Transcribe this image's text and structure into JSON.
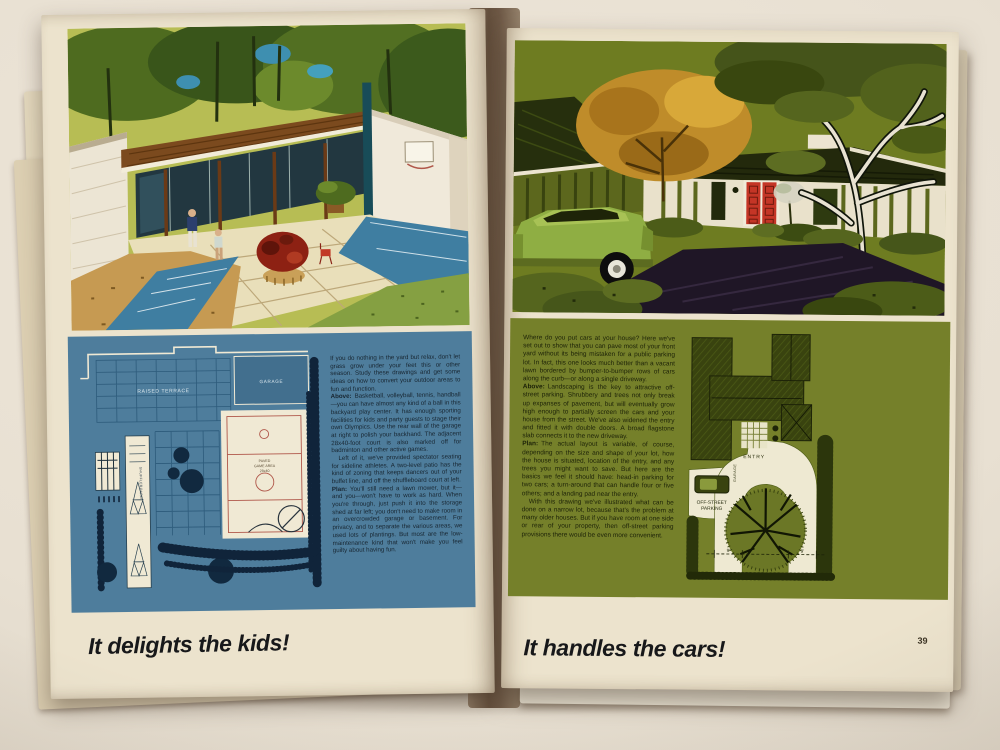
{
  "palette": {
    "page-cream": "#ece3cd",
    "gutter-brown": "#6e5a48",
    "panel-blue": "#4e7d9c",
    "plan-paper": "#f0e9d4",
    "plan-navy": "#14304a",
    "court-red": "#b0574a",
    "panel-olive": "#75802a",
    "roof-olive": "#39430f",
    "caption-black": "#17181a"
  },
  "left_page": {
    "plan": {
      "raised_terrace": "RAISED TERRACE",
      "garage": "GARAGE",
      "game_area_line1": "PAVED",
      "game_area_line2": "GAME AREA",
      "game_area_line3": "28x40",
      "shuffleboard": "SHUFFLEBOARD"
    },
    "text": {
      "paragraphs": [
        {
          "lead": "",
          "body": "If you do nothing in the yard but relax, don't let grass grow under your feet this or other season. Study these drawings and get some ideas on how to convert your outdoor areas to fun and function."
        },
        {
          "lead": "Above:",
          "body": "Basketball, volleyball, tennis, handball—you can have almost any kind of a ball in this backyard play center. It has enough sporting facilities for kids and party guests to stage their own Olympics. Use the rear wall of the garage at right to polish your backhand. The adjacent 28x40-foot court is also marked off for badminton and other active games."
        },
        {
          "lead": "",
          "body": "Left of it, we've provided spectator seating for sideline athletes. A two-level patio has the kind of zoning that keeps dancers out of your buffet line, and off the shuffleboard court at left."
        },
        {
          "lead": "Plan:",
          "body": "You'll still need a lawn mower, but it—and you—won't have to work as hard. When you're through, just push it into the storage shed at far left; you don't need to make room in an overcrowded garage or basement. For privacy, and to separate the various areas, we used lots of plantings. But most are the low-maintenance kind that won't make you feel guilty about having fun."
        }
      ]
    },
    "caption": "It delights the kids!"
  },
  "right_page": {
    "plan": {
      "entry": "ENTRY",
      "garage": "GARAGE",
      "parking_line1": "OFF-STREET",
      "parking_line2": "PARKING",
      "dim_left": "9'",
      "dim_right": "9'"
    },
    "text": {
      "paragraphs": [
        {
          "lead": "",
          "body": "Where do you put cars at your house? Here we've set out to show that you can pave most of your front yard without its being mistaken for a public parking lot. In fact, this one looks much better than a vacant lawn bordered by bumper-to-bumper rows of cars along the curb—or along a single driveway."
        },
        {
          "lead": "Above:",
          "body": "Landscaping is the key to attractive off-street parking. Shrubbery and trees not only break up expanses of pavement, but will eventually grow high enough to partially screen the cars and your house from the street. We've also widened the entry and fitted it with double doors. A broad flagstone slab connects it to the new driveway."
        },
        {
          "lead": "Plan:",
          "body": "The actual layout is variable, of course, depending on the size and shape of your lot, how the house is situated, location of the entry, and any trees you might want to save. But here are the basics we feel it should have: head-in parking for two cars; a turn-around that can handle four or five others; and a landing pad near the entry."
        },
        {
          "lead": "",
          "body": "With this drawing we've illustrated what can be done on a narrow lot, because that's the problem at many older houses. But if you have room at one side or rear of your property, then off-street parking provisions there would be even more convenient."
        }
      ]
    },
    "caption": "It handles the cars!",
    "page_number": "39"
  }
}
